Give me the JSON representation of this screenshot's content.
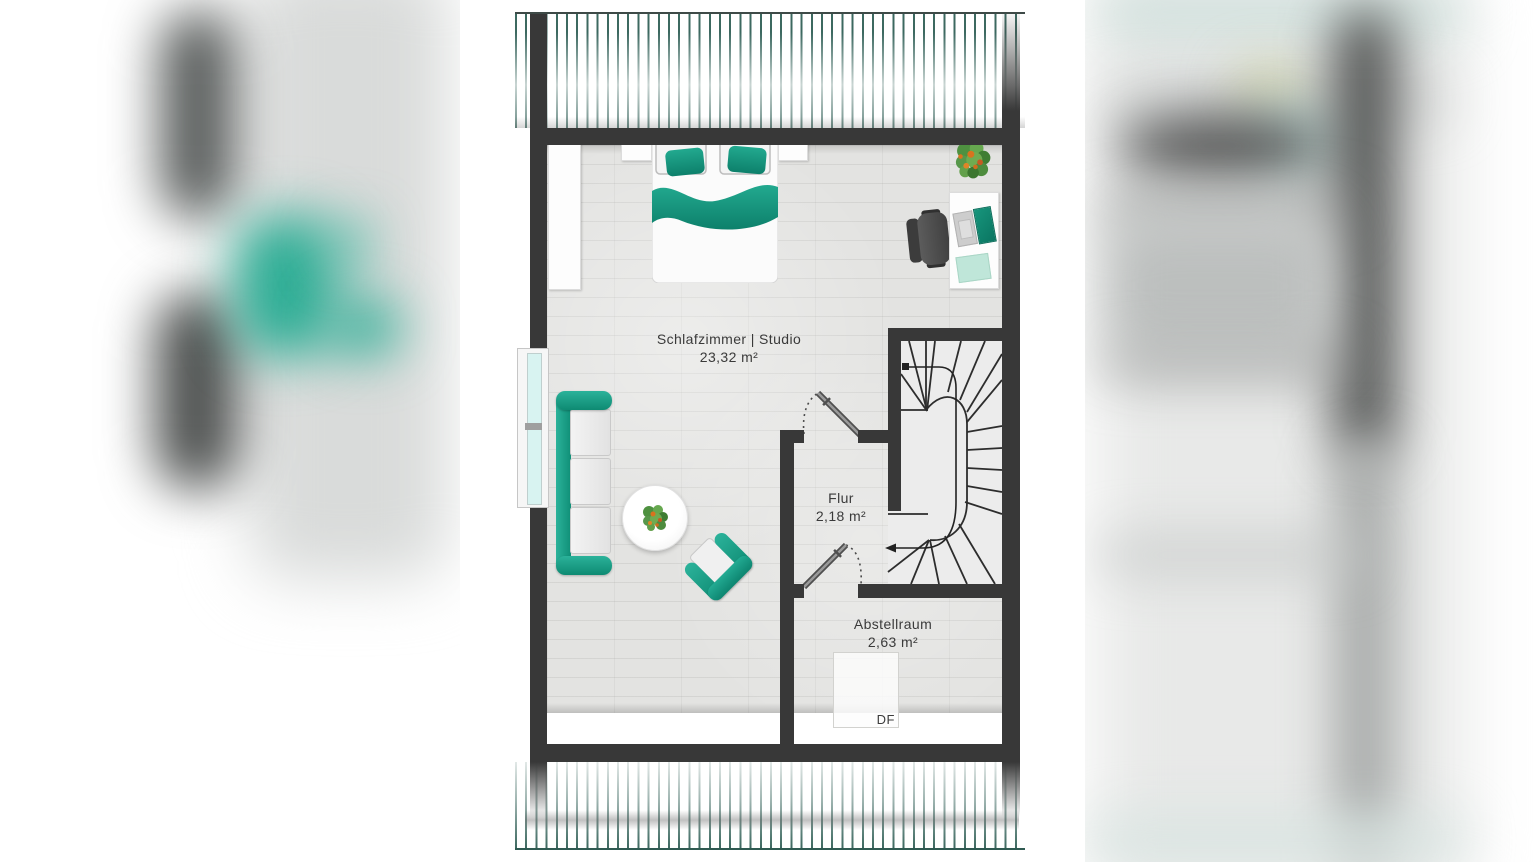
{
  "floorplan": {
    "rooms": [
      {
        "id": "schlafzimmer",
        "label": "Schlafzimmer | Studio",
        "area": "23,32 m²"
      },
      {
        "id": "flur",
        "label": "Flur",
        "area": "2,18 m²"
      },
      {
        "id": "abstellraum",
        "label": "Abstellraum",
        "area": "2,63 m²"
      }
    ],
    "skylight_label": "DF",
    "colors": {
      "accent_teal": "#14977e",
      "wall": "#383838",
      "floor": "#e3e3e1",
      "roof_hatch": "#2c5c53",
      "window_glass": "#d8f3f1",
      "stair_floor": "#ececec"
    }
  }
}
